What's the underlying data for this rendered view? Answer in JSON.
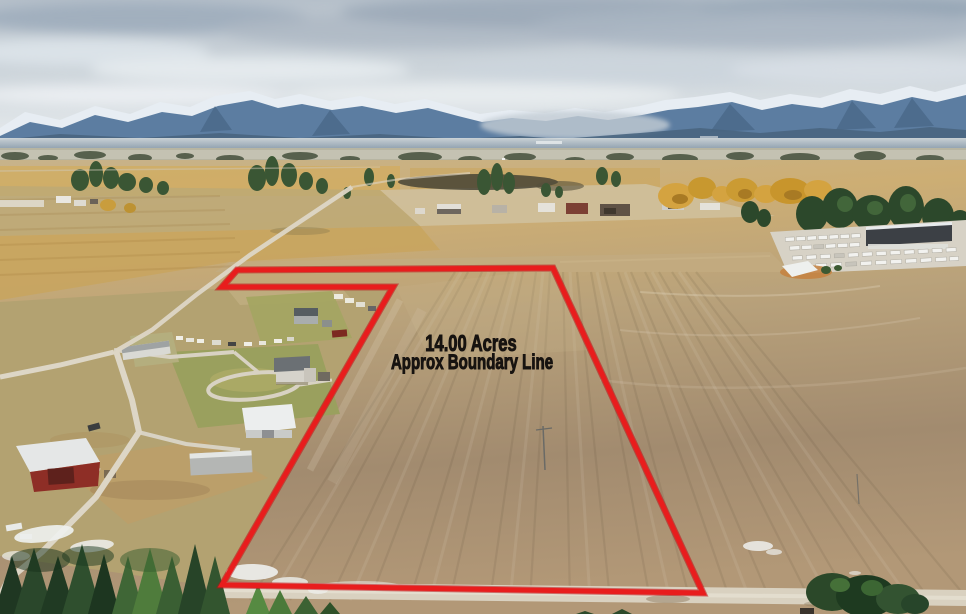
{
  "annotation": {
    "acreage": "14.00 Acres",
    "boundary_note": "Approx Boundary Line"
  },
  "colors": {
    "boundary_line": "#e81d1d",
    "boundary_line_edge": "#b91114",
    "label_text": "#171310"
  }
}
